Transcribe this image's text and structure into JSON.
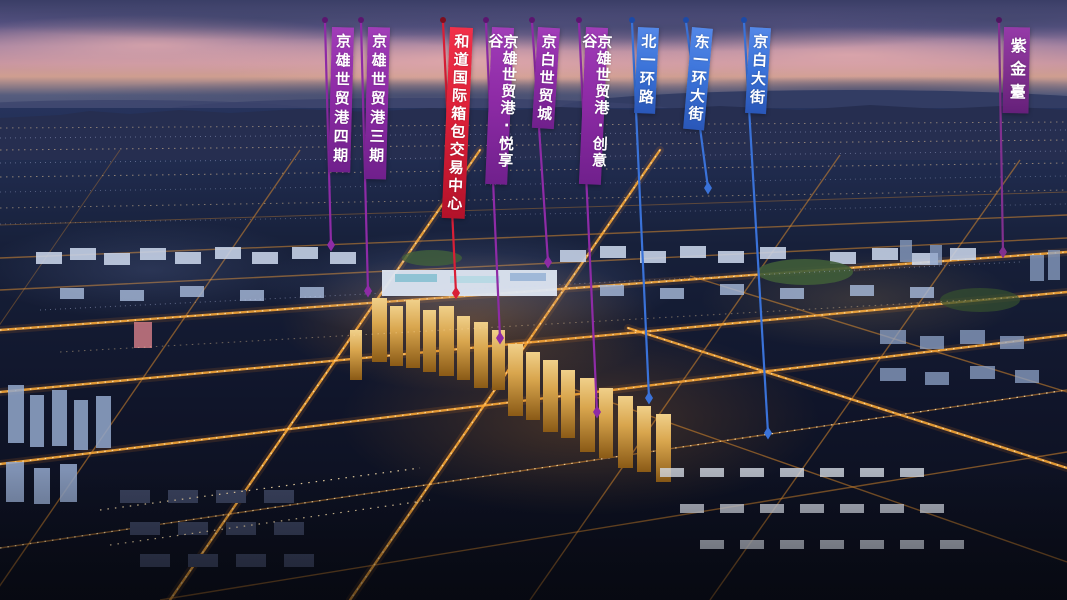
{
  "banners": [
    {
      "text": "京雄世贸港四期",
      "category": "development",
      "color_key": "purple"
    },
    {
      "text": "京雄世贸港三期",
      "category": "development",
      "color_key": "purple"
    },
    {
      "text": "和道国际箱包交易中心",
      "category": "development",
      "color_key": "red"
    },
    {
      "text": "京雄世贸港·悦享谷",
      "category": "development",
      "color_key": "purple"
    },
    {
      "text": "京白世贸城",
      "category": "development",
      "color_key": "purple"
    },
    {
      "text": "京雄世贸港·创意谷",
      "category": "development",
      "color_key": "purple"
    },
    {
      "text": "北一环路",
      "category": "road",
      "color_key": "blue"
    },
    {
      "text": "东一环大街",
      "category": "road",
      "color_key": "blue"
    },
    {
      "text": "京白大街",
      "category": "road",
      "color_key": "blue"
    },
    {
      "text": "紫金臺",
      "category": "development",
      "color_key": "purple_dark"
    }
  ],
  "colors": {
    "purple": "#8E2BA6",
    "purple_dark": "#81308F",
    "red": "#DD2038",
    "blue": "#3A72D8",
    "flag_text": "#FFFFFF",
    "street_glow": "#FFAB36"
  }
}
